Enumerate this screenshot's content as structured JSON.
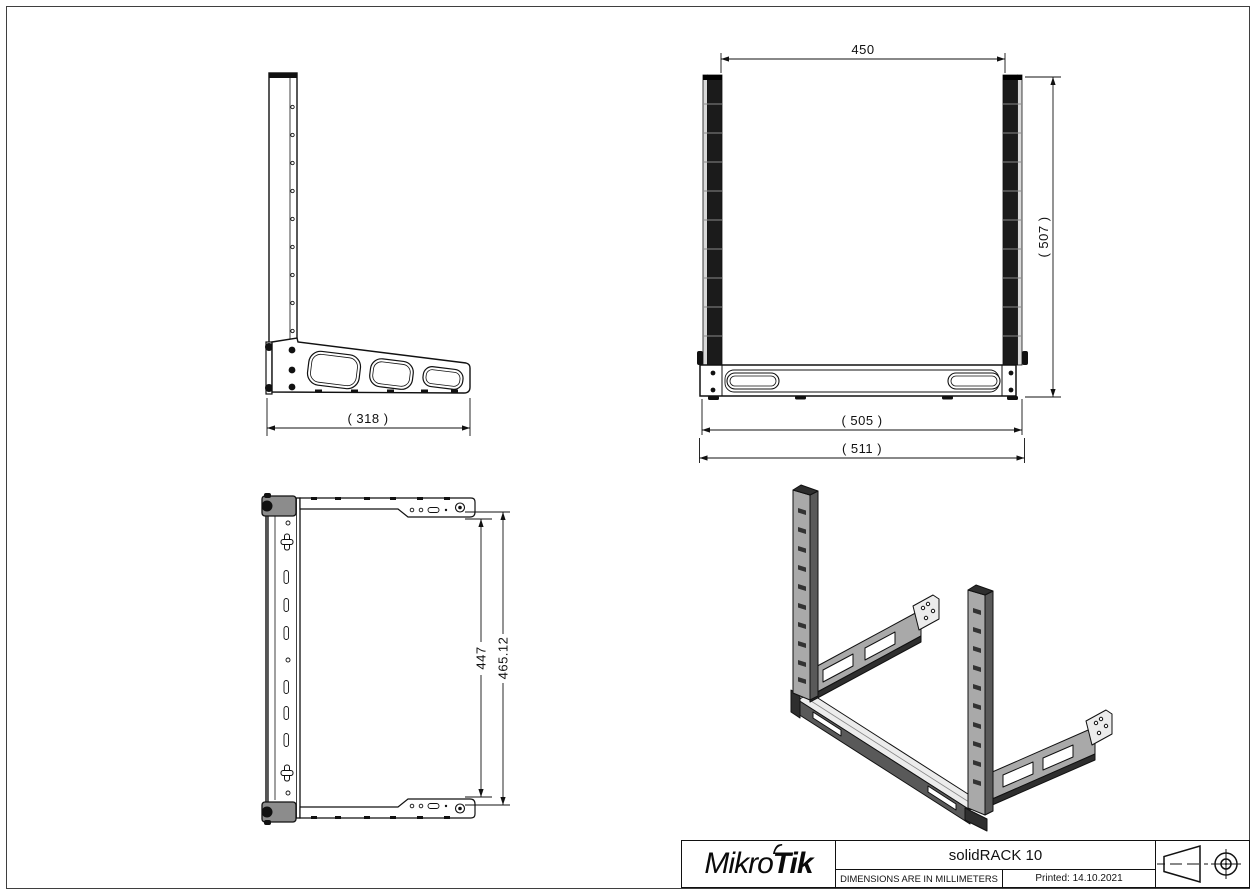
{
  "page": {
    "background": "#ffffff",
    "border_color": "#3f3f3f"
  },
  "drawing": {
    "dimensions": {
      "side_width": "( 318 )",
      "front_rail_spacing": "450",
      "front_height": "( 507 )",
      "front_width": "( 505 )",
      "front_width_overall": "( 511 )",
      "depth_inner": "447",
      "depth_overall": "465.12"
    },
    "views": {
      "side": "side-view",
      "front": "front-view",
      "plan": "plan-view",
      "isometric": "isometric-view"
    },
    "line_color": "#111111",
    "fill_light": "#ececec",
    "fill_mid": "#a9a9a9",
    "fill_dark": "#595959",
    "fill_black": "#1b1b1b",
    "cap_gray": "#8c8c8c"
  },
  "title_block": {
    "brand_prefix": "Mikro",
    "brand_suffix": "Tik",
    "product_name": "solidRACK 10",
    "units_note": "DIMENSIONS ARE IN MILLIMETERS",
    "printed": "Printed: 14.10.2021",
    "icons": {
      "projection": "first-angle-projection-cone-icon",
      "target": "concentric-target-icon"
    }
  }
}
